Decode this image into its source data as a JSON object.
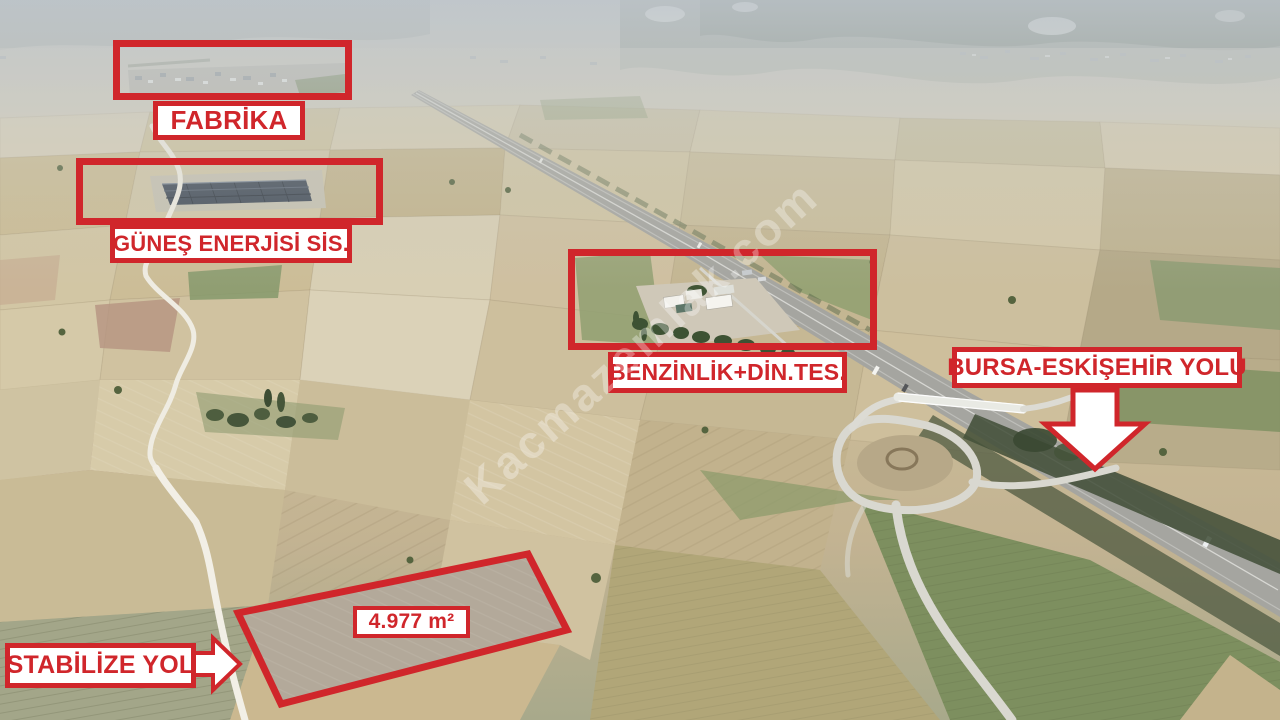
{
  "scene": {
    "description": "Aerial drone photo of farmland along a highway, real-estate listing annotation overlay",
    "watermark": "Kacmazemlak.com"
  },
  "annotations": {
    "fabrika": {
      "label": "FABRİKA"
    },
    "gunes": {
      "label": "GÜNEŞ ENERJİSİ SİS."
    },
    "benzinlik": {
      "label": "BENZİNLİK+DİN.TES."
    },
    "bursa": {
      "label": "BURSA-ESKİŞEHİR YOLU",
      "arrow": "down"
    },
    "stabilize": {
      "label": "STABİLİZE YOL",
      "arrow": "right"
    },
    "parcel": {
      "area_label": "4.977 m²"
    }
  },
  "colors": {
    "annotation_red": "#d0262b",
    "label_background": "#ffffff",
    "watermark_white": "rgba(255,255,255,0.32)"
  }
}
